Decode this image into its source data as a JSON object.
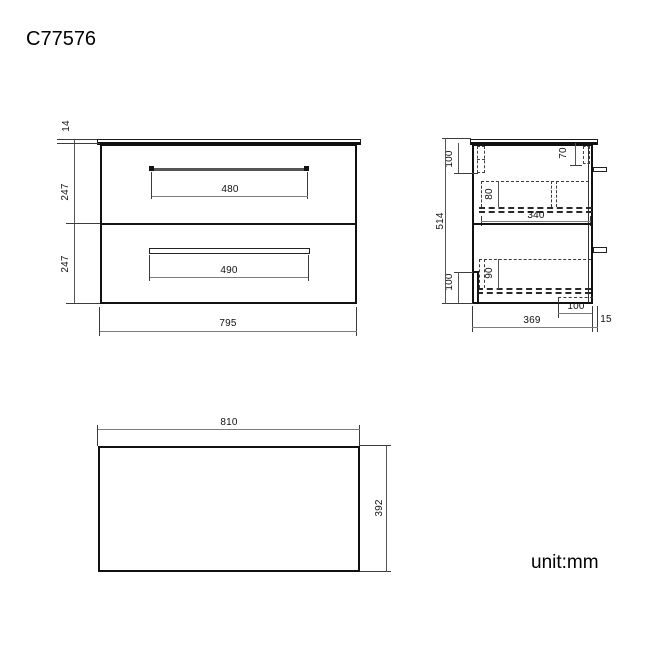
{
  "title": "C77576",
  "unit_label": "unit:mm",
  "views": {
    "front": {
      "top_thickness": "14",
      "drawer1_height": "247",
      "drawer2_height": "247",
      "handle1_width": "480",
      "handle2_width": "490",
      "overall_width": "795"
    },
    "side": {
      "total_height": "514",
      "top_left_offset": "100",
      "top_right_offset": "70",
      "drawer1_box_height": "80",
      "drawer_depth": "340",
      "drawer2_box_height": "90",
      "bottom_left_offset": "100",
      "bottom_recess": "100",
      "cabinet_depth": "369",
      "countertop_overhang": "15"
    },
    "plan": {
      "width": "810",
      "depth": "392"
    }
  }
}
